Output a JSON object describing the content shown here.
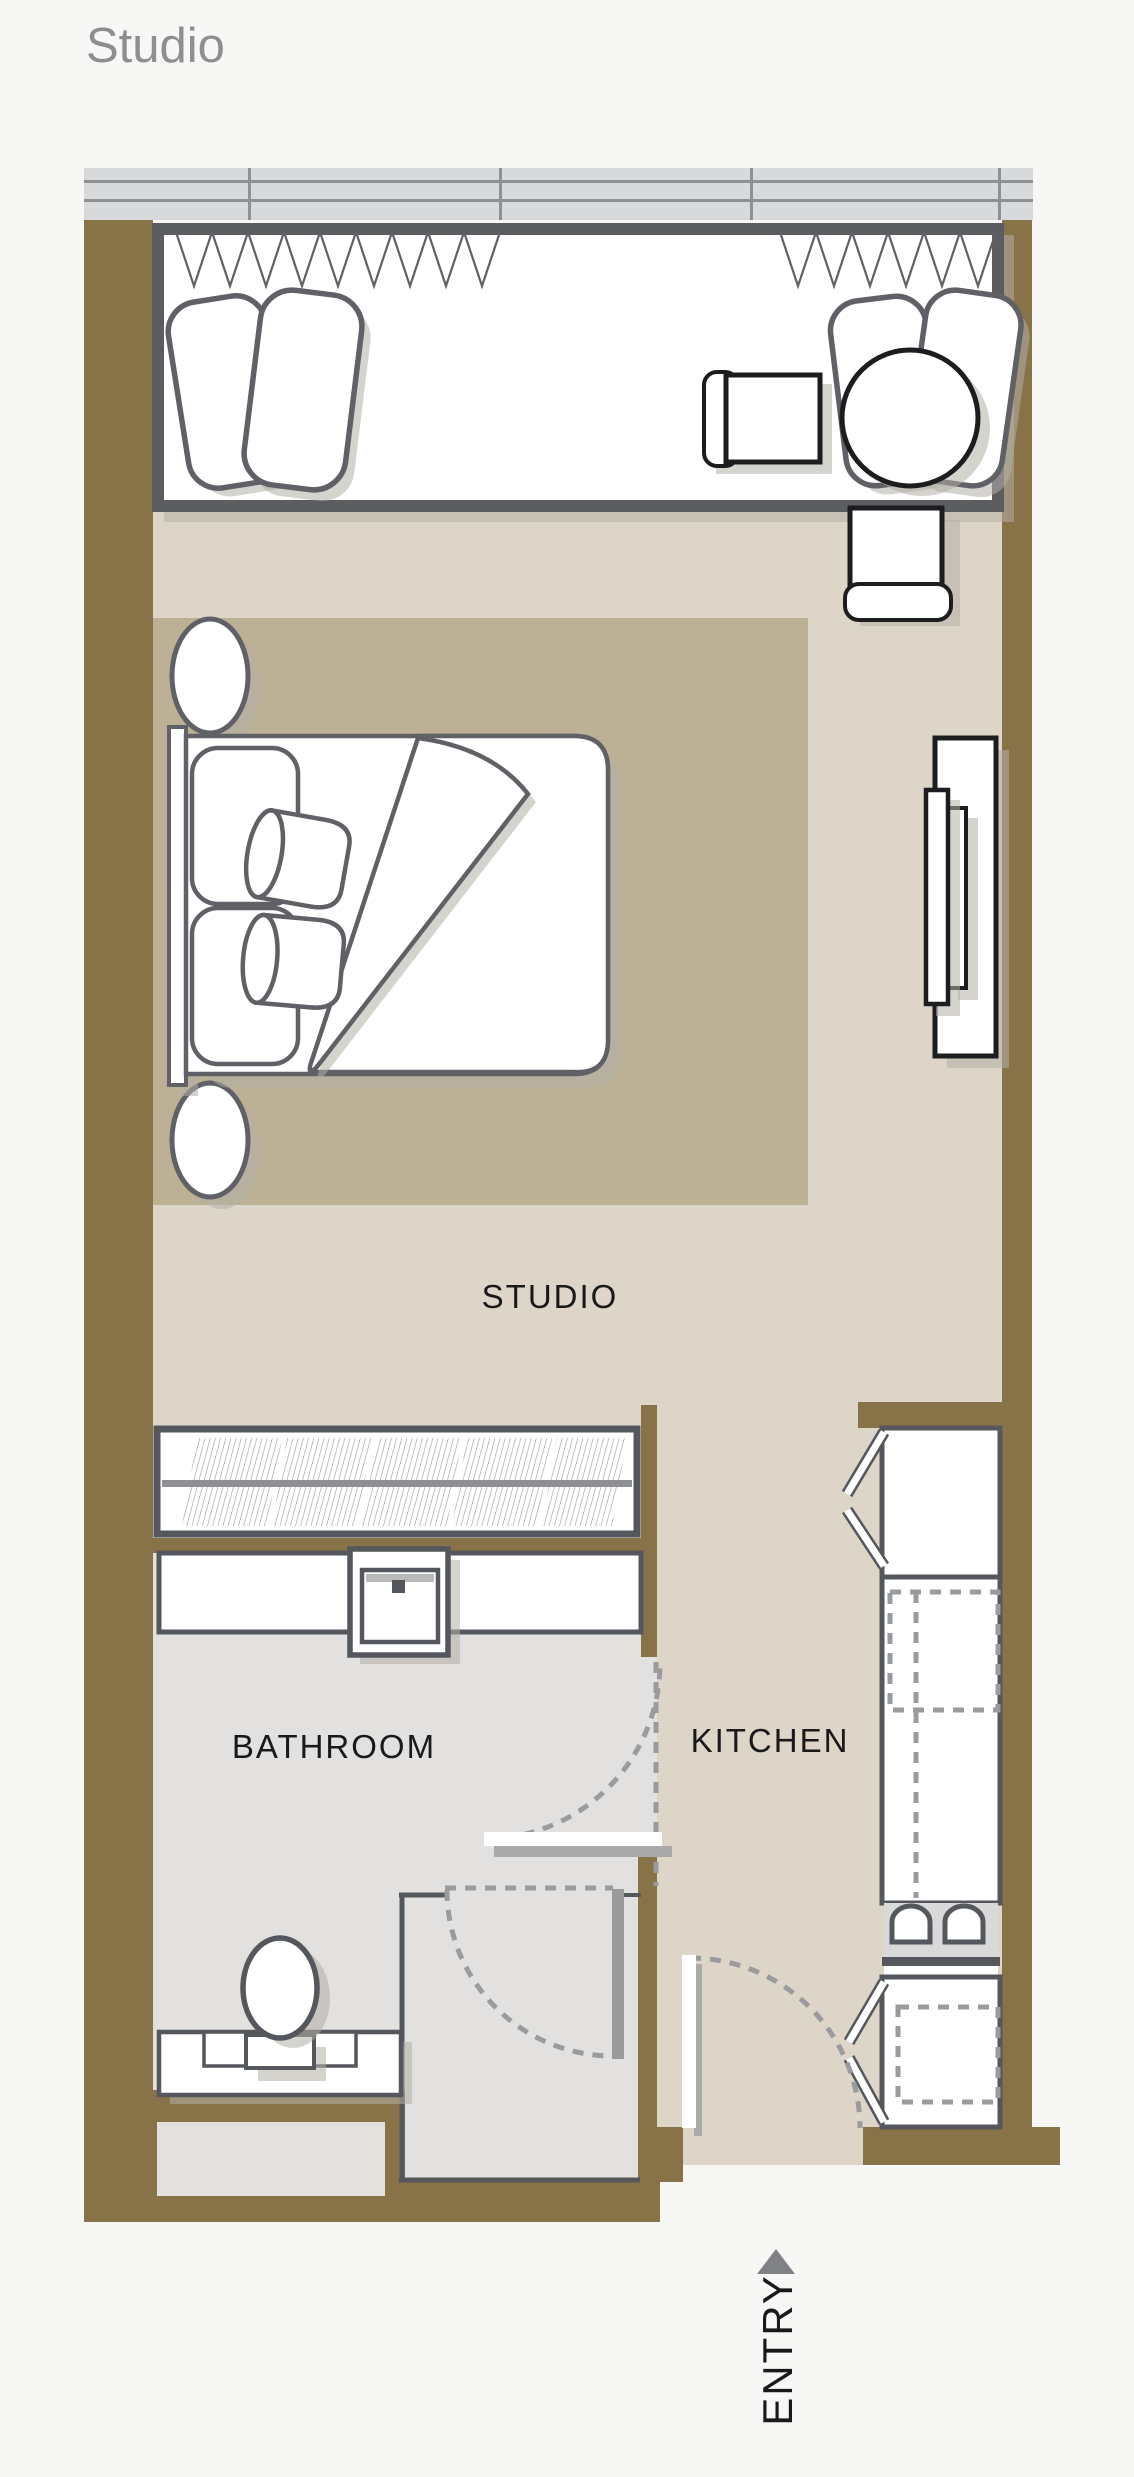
{
  "page": {
    "title": "Studio"
  },
  "plan": {
    "labels": {
      "studio": "STUDIO",
      "bathroom": "BATHROOM",
      "kitchen": "KITCHEN",
      "entry": "ENTRY"
    },
    "colors": {
      "page_bg": "#f7f7f6",
      "title_color": "#8e8e8e",
      "wall": "#877347",
      "floor": "#ddd5c8",
      "rug": "#bcb195",
      "bath_floor": "#e2e1e0",
      "band_bg": "#d8d9db",
      "band_line": "#8f9093",
      "outline": "#54575c",
      "furniture_dark": "#1c1d1f",
      "dashed": "#9a9b9d",
      "shadow": "#b3aea6",
      "cooktop": "#d9d9d9",
      "label_color": "#191919",
      "leaf_shadow": "#a9a9a9",
      "rail": "#8e9093"
    }
  }
}
